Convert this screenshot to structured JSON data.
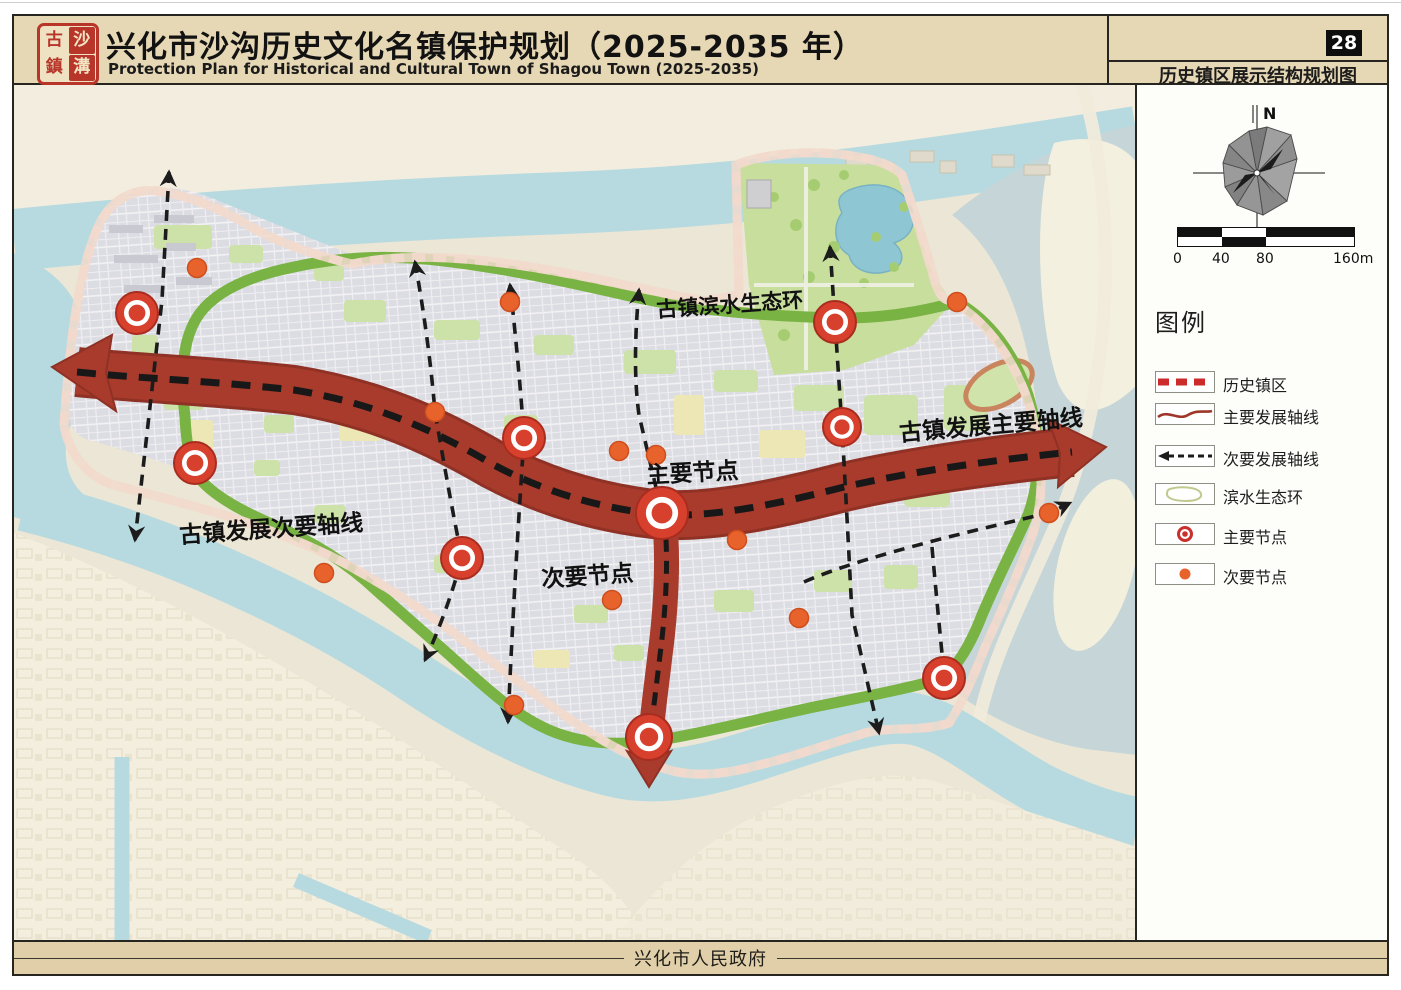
{
  "header": {
    "seal_chars": [
      "古",
      "沙",
      "鎮",
      "溝"
    ],
    "title": "兴化市沙沟历史文化名镇保护规划（2025-2035 年）",
    "subtitle_en": "Protection Plan for Historical and Cultural Town of Shagou Town (2025-2035)",
    "page_number": "28",
    "sheet_name": "历史镇区展示结构规划图"
  },
  "map": {
    "labels": {
      "waterfront_ring": "古镇滨水生态环",
      "main_axis": "古镇发展主要轴线",
      "major_node": "主要节点",
      "minor_node": "次要节点",
      "secondary_axis": "古镇发展次要轴线"
    },
    "major_nodes": [
      {
        "x": 123,
        "y": 228,
        "r": 21
      },
      {
        "x": 181,
        "y": 378,
        "r": 21
      },
      {
        "x": 510,
        "y": 353,
        "r": 21
      },
      {
        "x": 448,
        "y": 473,
        "r": 21
      },
      {
        "x": 648,
        "y": 428,
        "r": 26
      },
      {
        "x": 821,
        "y": 237,
        "r": 21
      },
      {
        "x": 828,
        "y": 342,
        "r": 19
      },
      {
        "x": 635,
        "y": 652,
        "r": 23
      },
      {
        "x": 930,
        "y": 593,
        "r": 21
      }
    ],
    "minor_nodes": [
      {
        "x": 183,
        "y": 183
      },
      {
        "x": 496,
        "y": 217
      },
      {
        "x": 421,
        "y": 327
      },
      {
        "x": 605,
        "y": 366
      },
      {
        "x": 642,
        "y": 370
      },
      {
        "x": 723,
        "y": 455
      },
      {
        "x": 785,
        "y": 533
      },
      {
        "x": 598,
        "y": 515
      },
      {
        "x": 500,
        "y": 620
      },
      {
        "x": 943,
        "y": 217
      },
      {
        "x": 1035,
        "y": 428
      },
      {
        "x": 310,
        "y": 488
      }
    ],
    "colors": {
      "node_red": "#d8402e",
      "node_orange": "#e8632c",
      "axis_red": "#a83b2c",
      "ring_green": "#79b343",
      "boundary_red": "#c9302c",
      "water_blue": "#b7dae0",
      "header_tan": "#e7d8b5"
    }
  },
  "sidebar": {
    "compass_label": "N",
    "scale": {
      "labels": [
        "0",
        "40",
        "80",
        "160m"
      ]
    },
    "legend_title": "图例",
    "legend": [
      {
        "label": "历史镇区",
        "symbol": "red-dashed-line"
      },
      {
        "label": "主要发展轴线",
        "symbol": "dark-red-curve"
      },
      {
        "label": "次要发展轴线",
        "symbol": "black-dashed-arrow"
      },
      {
        "label": "滨水生态环",
        "symbol": "green-ring-outline"
      },
      {
        "label": "主要节点",
        "symbol": "red-ring-dot"
      },
      {
        "label": "次要节点",
        "symbol": "orange-dot"
      }
    ]
  },
  "footer": {
    "publisher": "兴化市人民政府"
  }
}
